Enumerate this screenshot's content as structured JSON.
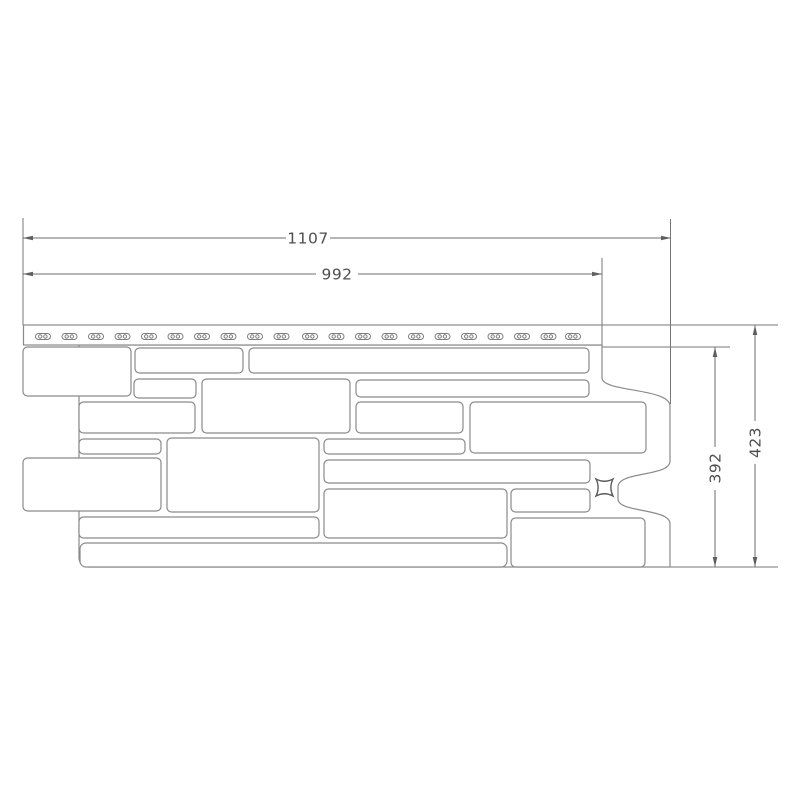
{
  "diagram": {
    "type": "technical-line-drawing",
    "subject": "decorative stone facade panel - front view with dimensions",
    "background_color": "#ffffff",
    "panel_line_color": "#8a8a8a",
    "dimension_line_color": "#6e6e6e",
    "text_color": "#4f4f4f",
    "dimensions": {
      "overall_width": "1107",
      "useful_width": "992",
      "overall_height": "423",
      "useful_height": "392"
    },
    "panel": {
      "nail_slot_count": 21,
      "stone_block_count": 18,
      "has_bottom_lip": true,
      "has_x_marker": true
    }
  }
}
